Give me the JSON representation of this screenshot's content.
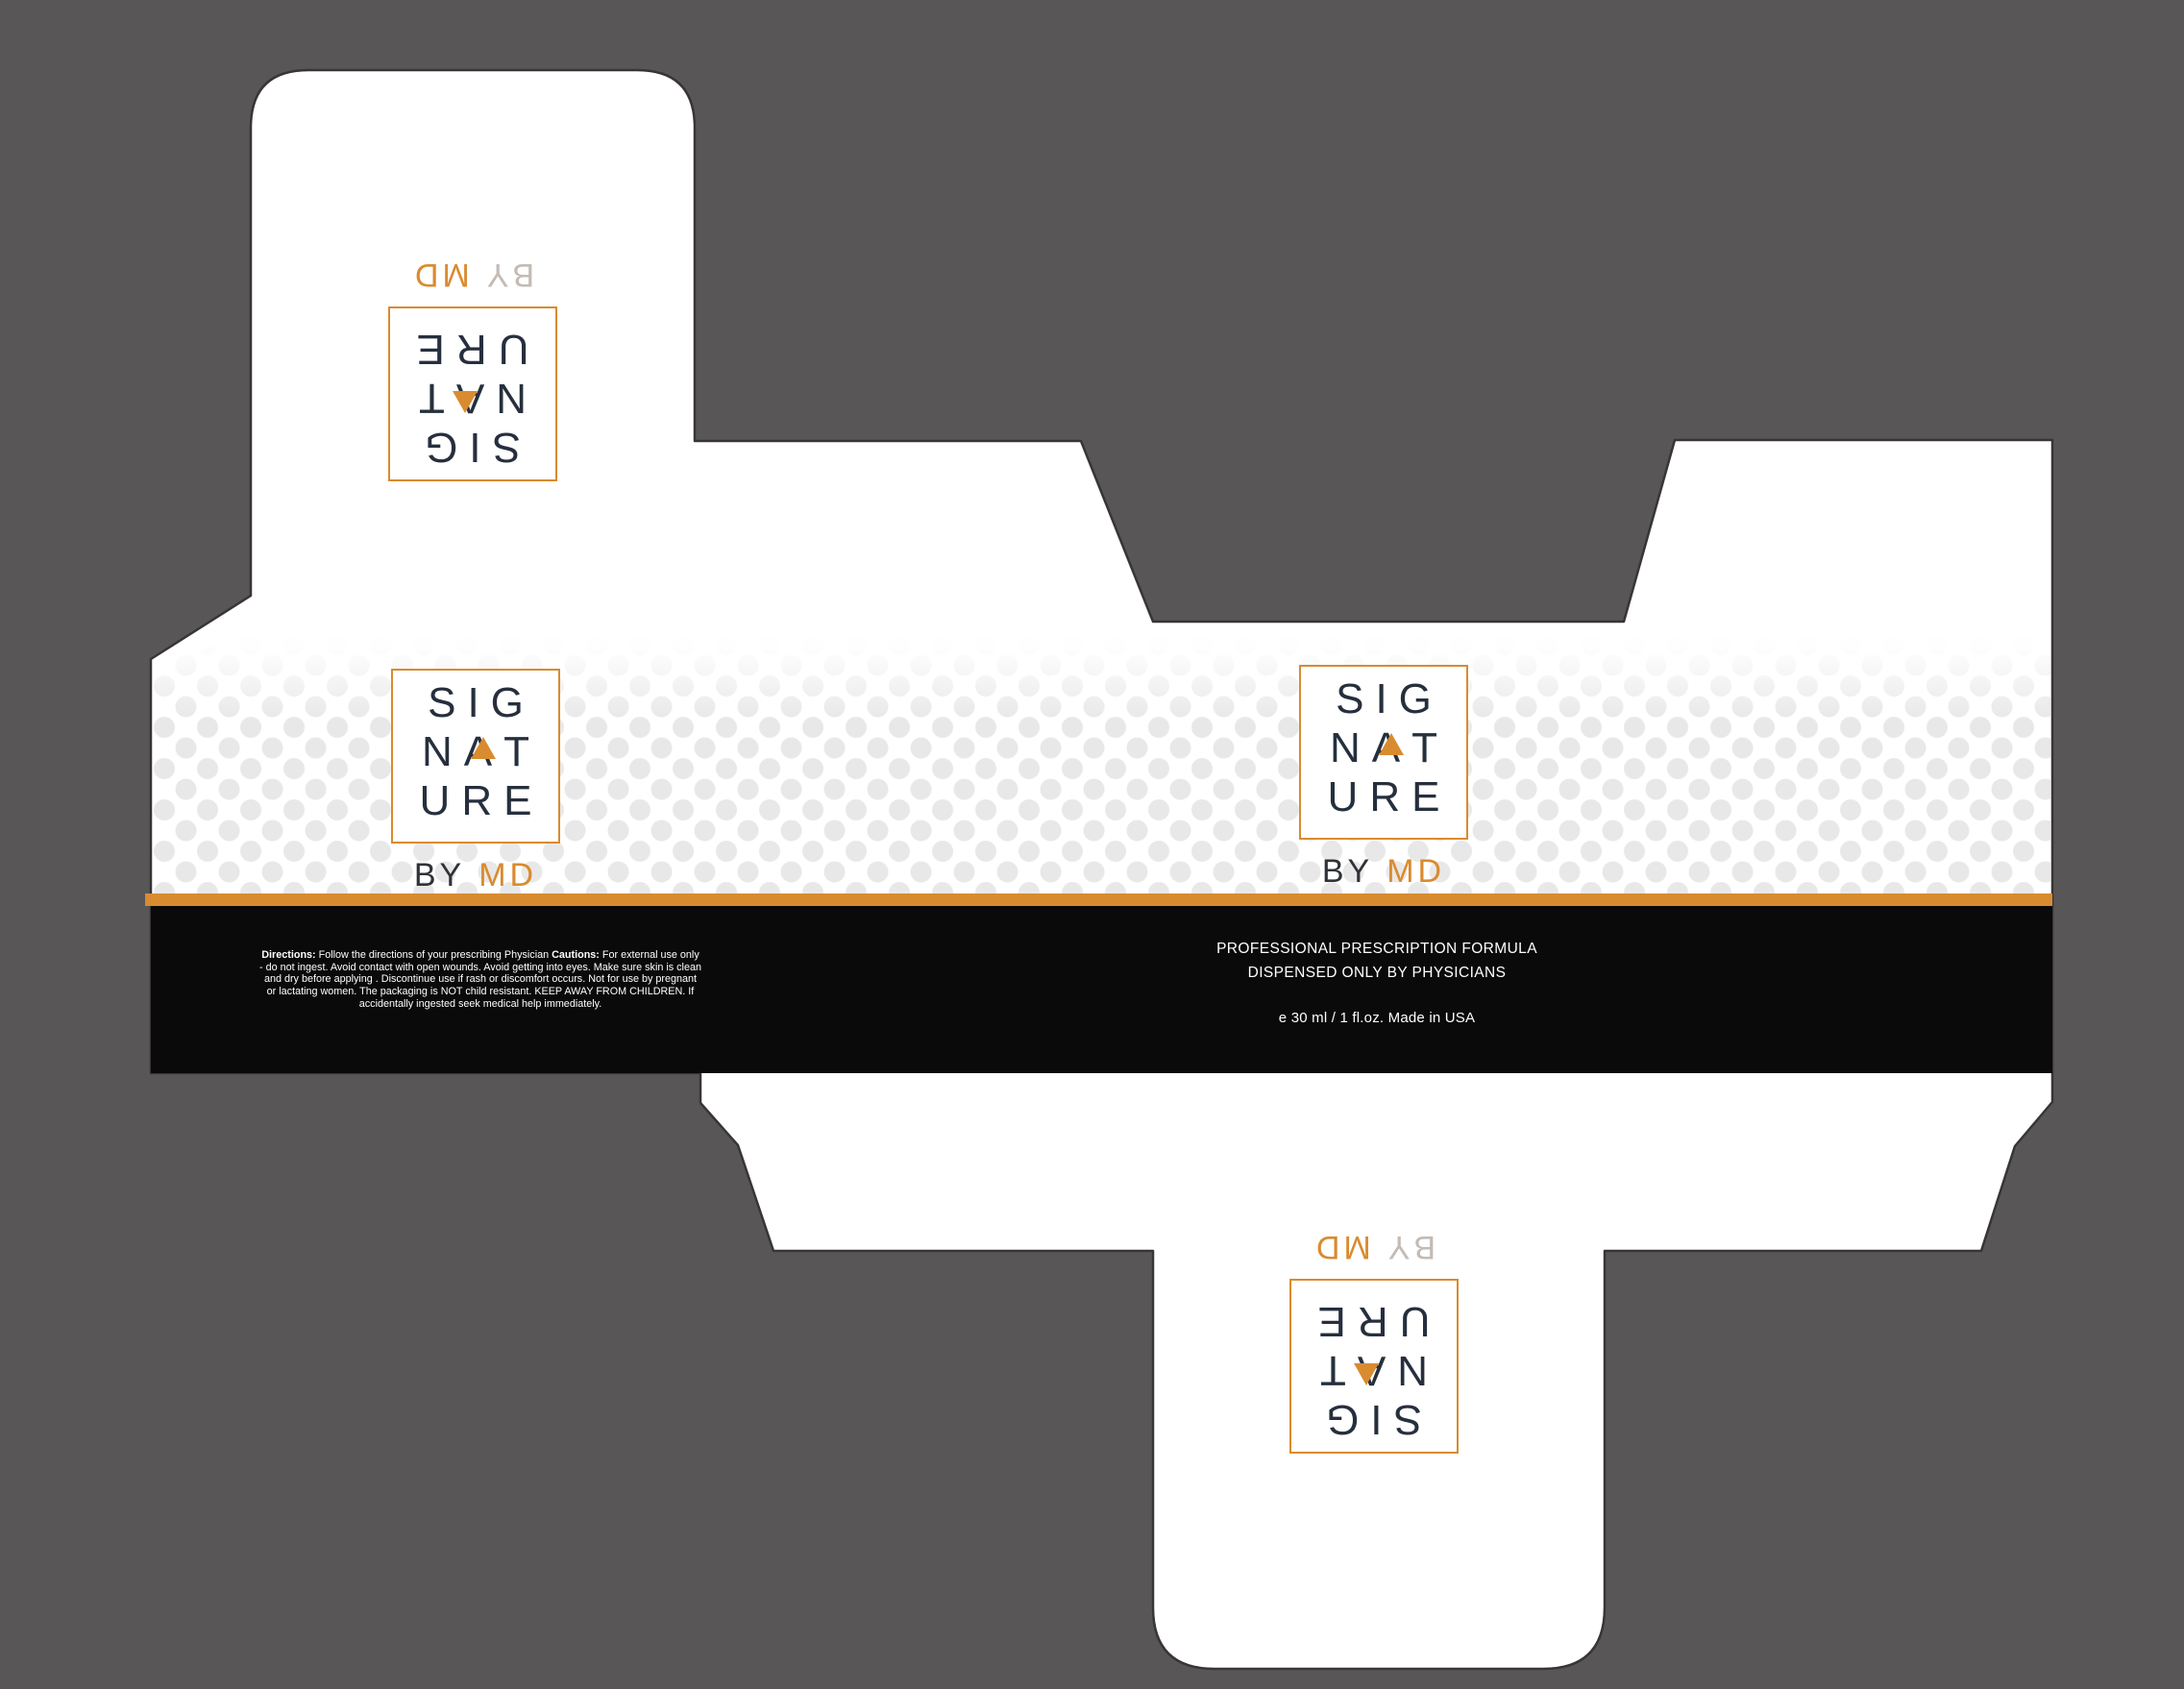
{
  "meta": {
    "artwork": "SIGNATURE BY MD folding-carton packaging dieline",
    "colors": {
      "background_gray": "#595657",
      "accent_orange": "#D98B2F",
      "ink_navy": "#262F3D",
      "band_black": "#0A0A0A",
      "halftone_dot": "#E9E8E8",
      "card_white": "#FFFFFF",
      "outline_stroke": "#383536",
      "rotated_by_gray": "#C3BBB5"
    }
  },
  "logo": {
    "row1": "SIG",
    "nat": [
      "N",
      "A",
      "T"
    ],
    "row3": "URE",
    "by": "BY",
    "md": "MD"
  },
  "band": {
    "directions_label": "Directions:",
    "directions_text": "Follow the directions of your prescribing Physician",
    "cautions_label": "Cautions:",
    "cautions_text": "For external use only - do not ingest. Avoid contact with open wounds. Avoid getting into eyes. Make sure skin is clean and dry before applying . Discontinue use if rash or discomfort occurs. Not for use by pregnant or lactating women. The packaging is NOT child resistant. KEEP AWAY FROM CHILDREN. If accidentally ingested seek medical help immediately.",
    "formula_line1": "PROFESSIONAL PRESCRIPTION FORMULA",
    "formula_line2": "DISPENSED ONLY BY PHYSICIANS",
    "volume_line": "e 30 ml / 1 fl.oz. Made in USA"
  }
}
